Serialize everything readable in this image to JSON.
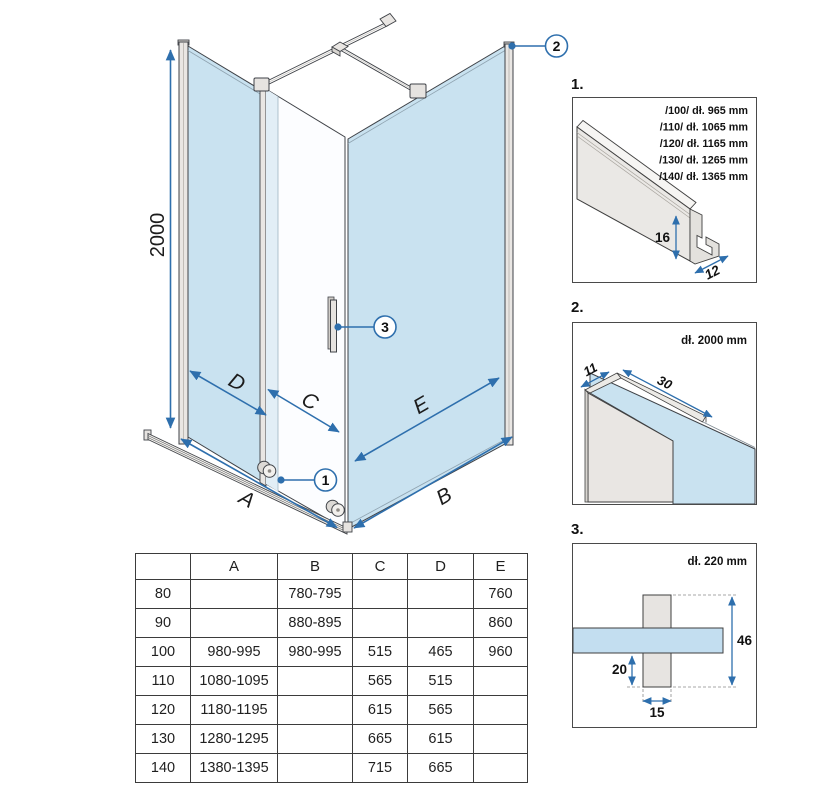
{
  "main": {
    "height_label": "2000",
    "dims": {
      "a": "A",
      "b": "B",
      "c": "C",
      "d": "D",
      "e": "E"
    },
    "callouts": [
      "1",
      "2",
      "3"
    ]
  },
  "details": [
    {
      "label": "1.",
      "list": [
        "/100/ dł. 965 mm",
        "/110/ dł. 1065 mm",
        "/120/ dł. 1165 mm",
        "/130/ dł. 1265 mm",
        "/140/ dł. 1365 mm"
      ],
      "dim_height": "16",
      "dim_depth": "12"
    },
    {
      "label": "2.",
      "title": "dł. 2000 mm",
      "dim_width": "11",
      "dim_depth": "30"
    },
    {
      "label": "3.",
      "title": "dł. 220 mm",
      "dim_height": "46",
      "dim_inset": "20",
      "dim_width": "15"
    }
  ],
  "table": {
    "headers": [
      "",
      "A",
      "B",
      "C",
      "D",
      "E"
    ],
    "rows": [
      [
        "80",
        "",
        "780-795",
        "",
        "",
        "760"
      ],
      [
        "90",
        "",
        "880-895",
        "",
        "",
        "860"
      ],
      [
        "100",
        "980-995",
        "980-995",
        "515",
        "465",
        "960"
      ],
      [
        "110",
        "1080-1095",
        "",
        "565",
        "515",
        ""
      ],
      [
        "120",
        "1180-1195",
        "",
        "615",
        "565",
        ""
      ],
      [
        "130",
        "1280-1295",
        "",
        "665",
        "615",
        ""
      ],
      [
        "140",
        "1380-1395",
        "",
        "715",
        "665",
        ""
      ]
    ]
  },
  "colors": {
    "glass_blue": "#c9e2f0",
    "dimension_blue": "#2e6fad",
    "metal_grey": "#e9e6e3",
    "line_dark": "#3f3f3f"
  }
}
